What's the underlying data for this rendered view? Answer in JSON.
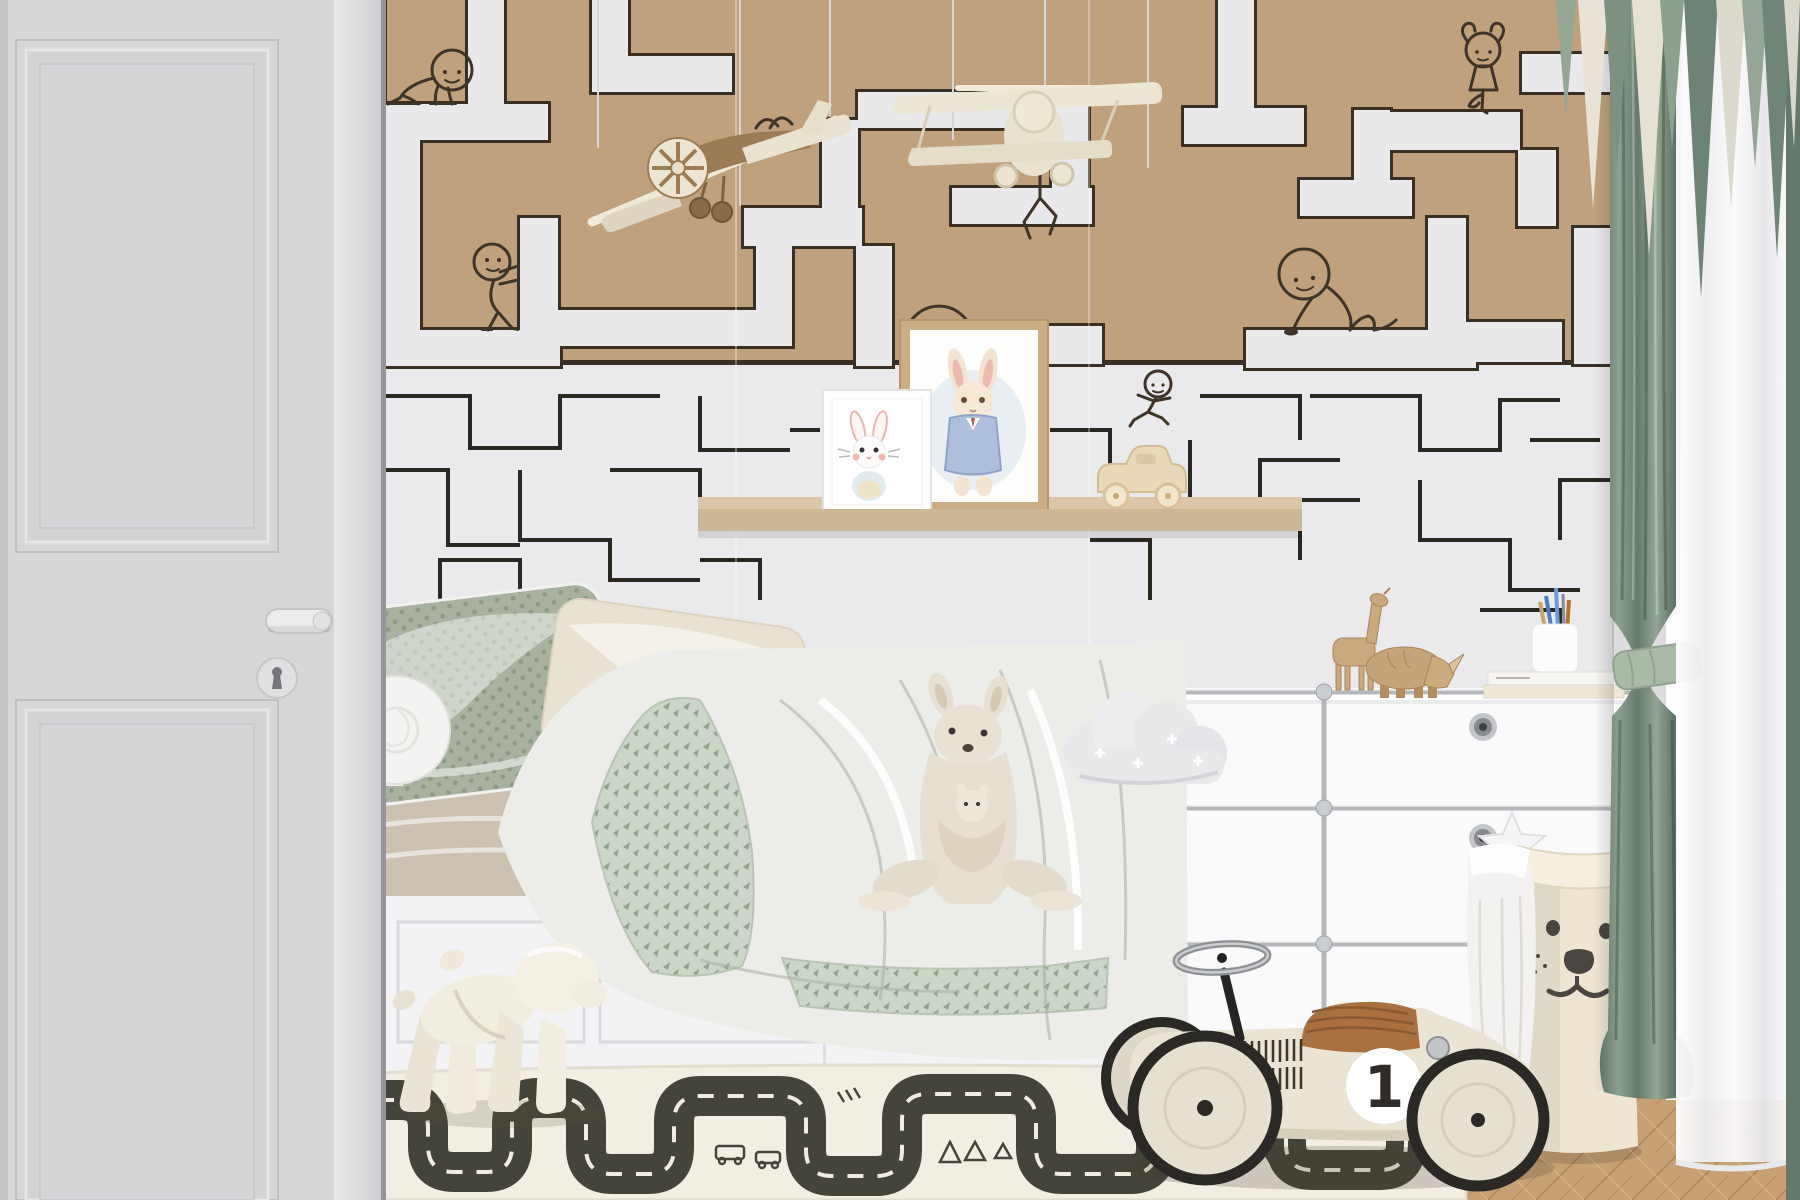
{
  "scene": {
    "type": "interior photo render",
    "room": "children's bedroom with maze wallpaper",
    "lighting": "soft daylight from right window"
  },
  "wallpaper": {
    "upper_maze": {
      "background": "#c0a17d",
      "path_color": "#e9e9ec",
      "outline_color": "#3a2f23"
    },
    "lower_maze": {
      "background": "#eaeaec",
      "line_color": "#2b2823"
    },
    "doodle_color": "#3f3428",
    "doodles": [
      "crawling child",
      "pushing child",
      "climbing child behind plane",
      "side-stretch child",
      "ballerina child",
      "running child",
      "handle arc above frame",
      "drawn cockpit"
    ]
  },
  "door": {
    "color": "#d7d6d8",
    "parts": [
      "upper molded panel",
      "lower molded panel",
      "lever handle",
      "keyhole rosette"
    ]
  },
  "mobiles": [
    {
      "name": "wooden toy plane",
      "body": "#9b7c55",
      "wings": "#e9e2d0"
    },
    {
      "name": "cream toy biplane",
      "body": "#e9e2d1"
    }
  ],
  "shelf": {
    "wood": "#d4bd9e",
    "prints": [
      {
        "name": "small white bunny watercolor",
        "frame": "white"
      },
      {
        "name": "bunny in blue jacket watercolor",
        "frame": "oak"
      }
    ],
    "toy": "wooden toy car"
  },
  "bed": {
    "base": "#f3f3f5",
    "sheet": "#cdc2b1",
    "pillows": [
      "sage patterned pillow",
      "cream linen pillow",
      "white bolster"
    ],
    "duvet": {
      "white": "#ecede9",
      "pattern_base": "#ccd6c8",
      "pattern_mark": "#93a48e"
    }
  },
  "toys": {
    "kangaroo_plush": "#e7dfd1",
    "cloud_pillow": "#e9e9ec",
    "dog_stool": "#f2ede1",
    "wooden_giraffe": "#c9a97d",
    "wooden_rhino": "#c4a478"
  },
  "dresser": {
    "style": "white modular with chrome frame",
    "body": "#fafafb",
    "chrome": "#b4b7bb",
    "knob_count": 2,
    "top_items": [
      "wooden giraffe",
      "wooden rhino",
      "pencil cup with pencils",
      "two books"
    ]
  },
  "laundry_bag": {
    "color": "#eee5d2",
    "face": "bear",
    "face_color": "#4a4742",
    "contents": [
      "white towel",
      "star pillow"
    ]
  },
  "ride_on_car": {
    "number": "1",
    "body": "#eae4d4",
    "seat": "#a8713f",
    "tires": "#2b2926",
    "roundel": "#ffffff"
  },
  "rug": {
    "base": "#f2eee4",
    "road": "#45443a",
    "dashes": "#efece2",
    "print": "road map with tree, car and tent doodles"
  },
  "curtains": {
    "green": "#7e9184",
    "sheer": "#f7f7f8",
    "tieback": "#a9baa6",
    "valance_colors": [
      "cream",
      "green",
      "gray-green"
    ]
  },
  "floor": {
    "left": "diagonal planks #c3996a",
    "right": "herringbone #c7a074"
  }
}
